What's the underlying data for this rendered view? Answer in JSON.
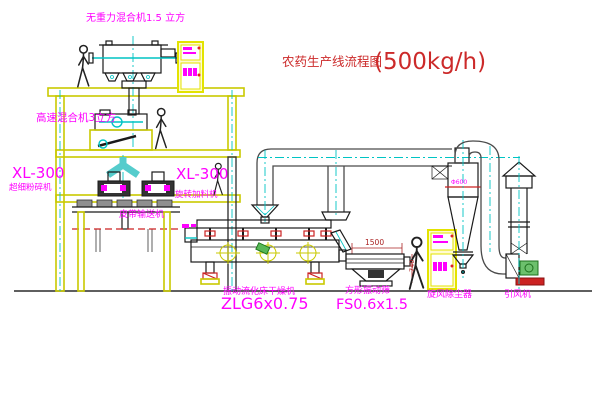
{
  "diagram": {
    "title": {
      "name": "农药生产线流程图",
      "capacity": "(500kg/h)"
    },
    "equipment": {
      "gravity_mixer": {
        "label": "无重力混合机1.5 立方"
      },
      "high_speed_mixer": {
        "label": "高速混合机3立方"
      },
      "pulverizer": {
        "model": "XL-300",
        "name": "超细粉碎机"
      },
      "rotary_feeder": {
        "model": "XL-300",
        "name": "旋转加料机"
      },
      "belt_conveyor": {
        "name": "皮带输送机"
      },
      "fluid_bed_dryer": {
        "name": "振动流化床干燥机",
        "model": "ZLG6x0.75"
      },
      "vibrating_sieve": {
        "name": "方形振动筛",
        "model": "FS0.6x1.5"
      },
      "cyclone": {
        "name": "旋风除尘器",
        "diameter": "Φ600"
      },
      "induced_draft_fan": {
        "name": "引风机"
      }
    },
    "dimensions": {
      "sieve_length": "1500",
      "sieve_height": "740"
    },
    "colors": {
      "structure_yellow": "#c9c900",
      "pipe_cyan": "#00c4c4",
      "label_magenta": "#ff00ff",
      "title_red": "#cc2a2a",
      "machine_black": "#1a1a1a",
      "alert_red": "#cc2222",
      "motor_green": "#58b858",
      "cabinet_yellow": "#e3e300"
    }
  }
}
